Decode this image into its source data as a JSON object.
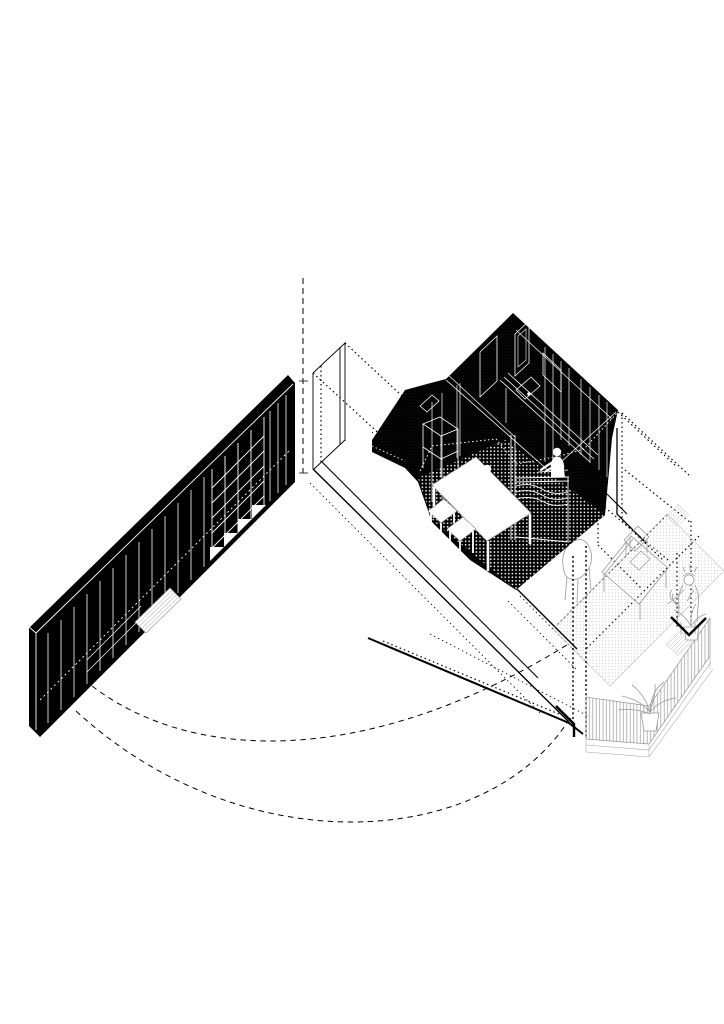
{
  "canvas": {
    "width": 724,
    "height": 1024,
    "background": "#ffffff"
  },
  "palette": {
    "ink": "#000000",
    "paper": "#ffffff",
    "light_line": "#aaaaaa",
    "mid_line": "#999999",
    "stipple_dot": "#b5b5b5"
  },
  "drawing": {
    "type": "axonometric-interior-cutaway",
    "elements": {
      "leader_line": {
        "label": "vertical dashed leader line marking the room corner"
      },
      "room_outline": {
        "label": "dotted outline of the transparent room volume"
      },
      "wall_stub": {
        "label": "solid outline of wall stub at room corner"
      },
      "floor_edges": {
        "label": "solid floor edge lines of the removed front wall"
      },
      "wardrobe_wall": {
        "label": "black wardrobe wall with panel doors, shelving grid, stair steps and drawers"
      },
      "bench": {
        "label": "white slatted bench in front of wardrobe wall"
      },
      "kitchen_volume": {
        "label": "black kitchen volume with white cabinet linework"
      },
      "kitchen_floor": {
        "label": "dark kitchen floor with dot texture"
      },
      "kitchen_island": {
        "label": "kitchen island counter with fluted front"
      },
      "dining_table": {
        "label": "white dining table"
      },
      "stools": {
        "label": "two white stools beside the table"
      },
      "figure_at_table": {
        "label": "white silhouette of person standing at table"
      },
      "figure_at_counter": {
        "label": "white silhouette of person working at kitchen island"
      },
      "terrace_floor": {
        "label": "stippled terrace floor"
      },
      "desk": {
        "label": "outlined desk on terrace"
      },
      "chair": {
        "label": "outlined chair"
      },
      "desk_chair": {
        "label": "small chair at desk"
      },
      "person_terrace": {
        "label": "outlined person holding a plant on terrace"
      },
      "plant_balcony": {
        "label": "potted plant on balcony"
      },
      "plant_terrace": {
        "label": "potted plant beside terrace person"
      },
      "railing": {
        "label": "balcony railing with vertical balusters"
      },
      "doormats": {
        "label": "small hatched floor mats"
      },
      "corner_marks": {
        "label": "thick black wall corner marks"
      },
      "view_arc_inner": {
        "label": "inner dashed view arc"
      },
      "view_arc_outer": {
        "label": "outer dashed view arc"
      }
    }
  }
}
